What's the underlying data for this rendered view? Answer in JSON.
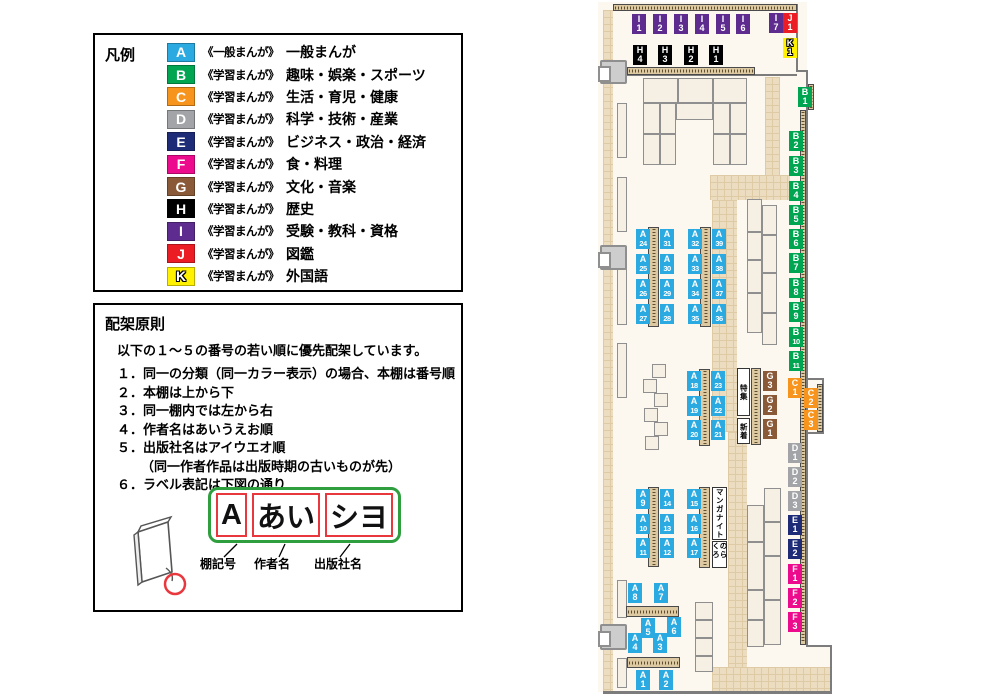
{
  "legend": {
    "title": "凡例",
    "items": [
      {
        "code": "A",
        "color": "#2BA9E1",
        "scope": "《一般まんが》",
        "label": "一般まんが"
      },
      {
        "code": "B",
        "color": "#00A551",
        "scope": "《学習まんが》",
        "label": "趣味・娯楽・スポーツ"
      },
      {
        "code": "C",
        "color": "#F7941E",
        "scope": "《学習まんが》",
        "label": "生活・育児・健康"
      },
      {
        "code": "D",
        "color": "#A2A4A7",
        "scope": "《学習まんが》",
        "label": "科学・技術・産業"
      },
      {
        "code": "E",
        "color": "#1E2C78",
        "scope": "《学習まんが》",
        "label": "ビジネス・政治・経済"
      },
      {
        "code": "F",
        "color": "#EC0B8C",
        "scope": "《学習まんが》",
        "label": "食・料理"
      },
      {
        "code": "G",
        "color": "#8A5A38",
        "scope": "《学習まんが》",
        "label": "文化・音楽"
      },
      {
        "code": "H",
        "color": "#000000",
        "scope": "《学習まんが》",
        "label": "歴史"
      },
      {
        "code": "I",
        "color": "#5E2C8E",
        "scope": "《学習まんが》",
        "label": "受験・教科・資格"
      },
      {
        "code": "J",
        "color": "#EC1C24",
        "scope": "《学習まんが》",
        "label": "図鑑"
      },
      {
        "code": "K",
        "color": "#FFF100",
        "scope": "《学習まんが》",
        "label": "外国語",
        "outline": true
      }
    ]
  },
  "principles": {
    "title": "配架原則",
    "intro": "以下の１～５の番号の若い順に優先配架しています。",
    "rules": [
      {
        "num": "１．",
        "text": "同一の分類（同一カラー表示）の場合、本棚は番号順"
      },
      {
        "num": "２．",
        "text": "本棚は上から下"
      },
      {
        "num": "３．",
        "text": "同一棚内では左から右"
      },
      {
        "num": "４．",
        "text": "作者名はあいうえお順"
      },
      {
        "num": "５．",
        "text": "出版社名はアイウエオ順",
        "sub": "（同一作者作品は出版時期の古いものが先）"
      },
      {
        "num": "６．",
        "text": "ラベル表記は下図の通り"
      }
    ],
    "label_diagram": {
      "boxes": [
        "A",
        "あい",
        "シヨ"
      ],
      "captions": [
        "棚記号",
        "作者名",
        "出版社名"
      ]
    }
  },
  "map": {
    "category_colors": {
      "A": "#2BA9E1",
      "B": "#00A551",
      "C": "#F7941E",
      "D": "#A2A4A7",
      "E": "#1E2C78",
      "F": "#EC0B8C",
      "G": "#8A5A38",
      "H": "#000000",
      "I": "#5E2C8E",
      "J": "#EC1C24",
      "K": "#FFF100"
    },
    "signs": {
      "feature": "特集",
      "new_arrivals": "新着",
      "manga_night": "マンガナイト",
      "norakuro": "のらくろ"
    },
    "labels": [
      {
        "c": "I",
        "n": "1",
        "x": 632,
        "y": 14
      },
      {
        "c": "I",
        "n": "2",
        "x": 653,
        "y": 14
      },
      {
        "c": "I",
        "n": "3",
        "x": 674,
        "y": 14
      },
      {
        "c": "I",
        "n": "4",
        "x": 695,
        "y": 14
      },
      {
        "c": "I",
        "n": "5",
        "x": 716,
        "y": 14
      },
      {
        "c": "I",
        "n": "6",
        "x": 736,
        "y": 14
      },
      {
        "c": "I",
        "n": "7",
        "x": 769,
        "y": 13
      },
      {
        "c": "J",
        "n": "1",
        "x": 783,
        "y": 13
      },
      {
        "c": "K",
        "n": "1",
        "x": 783,
        "y": 38
      },
      {
        "c": "H",
        "n": "4",
        "x": 633,
        "y": 45
      },
      {
        "c": "H",
        "n": "3",
        "x": 658,
        "y": 45
      },
      {
        "c": "H",
        "n": "2",
        "x": 684,
        "y": 45
      },
      {
        "c": "H",
        "n": "1",
        "x": 709,
        "y": 45
      },
      {
        "c": "B",
        "n": "1",
        "x": 798,
        "y": 87
      },
      {
        "c": "B",
        "n": "2",
        "x": 789,
        "y": 131
      },
      {
        "c": "B",
        "n": "3",
        "x": 789,
        "y": 156
      },
      {
        "c": "B",
        "n": "4",
        "x": 789,
        "y": 181
      },
      {
        "c": "B",
        "n": "5",
        "x": 789,
        "y": 205
      },
      {
        "c": "B",
        "n": "6",
        "x": 789,
        "y": 229
      },
      {
        "c": "B",
        "n": "7",
        "x": 789,
        "y": 253
      },
      {
        "c": "B",
        "n": "8",
        "x": 789,
        "y": 278
      },
      {
        "c": "B",
        "n": "9",
        "x": 789,
        "y": 302
      },
      {
        "c": "B",
        "n": "10",
        "x": 789,
        "y": 327
      },
      {
        "c": "B",
        "n": "11",
        "x": 789,
        "y": 351
      },
      {
        "c": "C",
        "n": "1",
        "x": 788,
        "y": 378
      },
      {
        "c": "C",
        "n": "2",
        "x": 804,
        "y": 388
      },
      {
        "c": "C",
        "n": "3",
        "x": 804,
        "y": 410
      },
      {
        "c": "D",
        "n": "1",
        "x": 788,
        "y": 443
      },
      {
        "c": "D",
        "n": "2",
        "x": 788,
        "y": 467
      },
      {
        "c": "D",
        "n": "3",
        "x": 788,
        "y": 491
      },
      {
        "c": "E",
        "n": "1",
        "x": 788,
        "y": 515
      },
      {
        "c": "E",
        "n": "2",
        "x": 788,
        "y": 539
      },
      {
        "c": "F",
        "n": "1",
        "x": 788,
        "y": 564
      },
      {
        "c": "F",
        "n": "2",
        "x": 788,
        "y": 588
      },
      {
        "c": "F",
        "n": "3",
        "x": 788,
        "y": 612
      },
      {
        "c": "G",
        "n": "3",
        "x": 763,
        "y": 371
      },
      {
        "c": "G",
        "n": "2",
        "x": 763,
        "y": 395
      },
      {
        "c": "G",
        "n": "1",
        "x": 763,
        "y": 419
      },
      {
        "c": "A",
        "n": "24",
        "x": 636,
        "y": 229
      },
      {
        "c": "A",
        "n": "25",
        "x": 636,
        "y": 254
      },
      {
        "c": "A",
        "n": "26",
        "x": 636,
        "y": 279
      },
      {
        "c": "A",
        "n": "27",
        "x": 636,
        "y": 304
      },
      {
        "c": "A",
        "n": "31",
        "x": 660,
        "y": 229
      },
      {
        "c": "A",
        "n": "30",
        "x": 660,
        "y": 254
      },
      {
        "c": "A",
        "n": "29",
        "x": 660,
        "y": 279
      },
      {
        "c": "A",
        "n": "28",
        "x": 660,
        "y": 304
      },
      {
        "c": "A",
        "n": "32",
        "x": 688,
        "y": 229
      },
      {
        "c": "A",
        "n": "33",
        "x": 688,
        "y": 254
      },
      {
        "c": "A",
        "n": "34",
        "x": 688,
        "y": 279
      },
      {
        "c": "A",
        "n": "35",
        "x": 688,
        "y": 304
      },
      {
        "c": "A",
        "n": "39",
        "x": 712,
        "y": 229
      },
      {
        "c": "A",
        "n": "38",
        "x": 712,
        "y": 254
      },
      {
        "c": "A",
        "n": "37",
        "x": 712,
        "y": 279
      },
      {
        "c": "A",
        "n": "36",
        "x": 712,
        "y": 304
      },
      {
        "c": "A",
        "n": "18",
        "x": 687,
        "y": 371
      },
      {
        "c": "A",
        "n": "19",
        "x": 687,
        "y": 396
      },
      {
        "c": "A",
        "n": "20",
        "x": 687,
        "y": 420
      },
      {
        "c": "A",
        "n": "23",
        "x": 711,
        "y": 371
      },
      {
        "c": "A",
        "n": "22",
        "x": 711,
        "y": 396
      },
      {
        "c": "A",
        "n": "21",
        "x": 711,
        "y": 420
      },
      {
        "c": "A",
        "n": "9",
        "x": 636,
        "y": 489
      },
      {
        "c": "A",
        "n": "10",
        "x": 636,
        "y": 514
      },
      {
        "c": "A",
        "n": "11",
        "x": 636,
        "y": 538
      },
      {
        "c": "A",
        "n": "14",
        "x": 660,
        "y": 489
      },
      {
        "c": "A",
        "n": "13",
        "x": 660,
        "y": 514
      },
      {
        "c": "A",
        "n": "12",
        "x": 660,
        "y": 538
      },
      {
        "c": "A",
        "n": "15",
        "x": 687,
        "y": 489
      },
      {
        "c": "A",
        "n": "16",
        "x": 687,
        "y": 514
      },
      {
        "c": "A",
        "n": "17",
        "x": 687,
        "y": 538
      },
      {
        "c": "A",
        "n": "8",
        "x": 628,
        "y": 583
      },
      {
        "c": "A",
        "n": "7",
        "x": 654,
        "y": 583
      },
      {
        "c": "A",
        "n": "5",
        "x": 641,
        "y": 618
      },
      {
        "c": "A",
        "n": "6",
        "x": 667,
        "y": 617
      },
      {
        "c": "A",
        "n": "4",
        "x": 628,
        "y": 633
      },
      {
        "c": "A",
        "n": "3",
        "x": 653,
        "y": 633
      },
      {
        "c": "A",
        "n": "1",
        "x": 636,
        "y": 670
      },
      {
        "c": "A",
        "n": "2",
        "x": 659,
        "y": 670
      }
    ]
  }
}
